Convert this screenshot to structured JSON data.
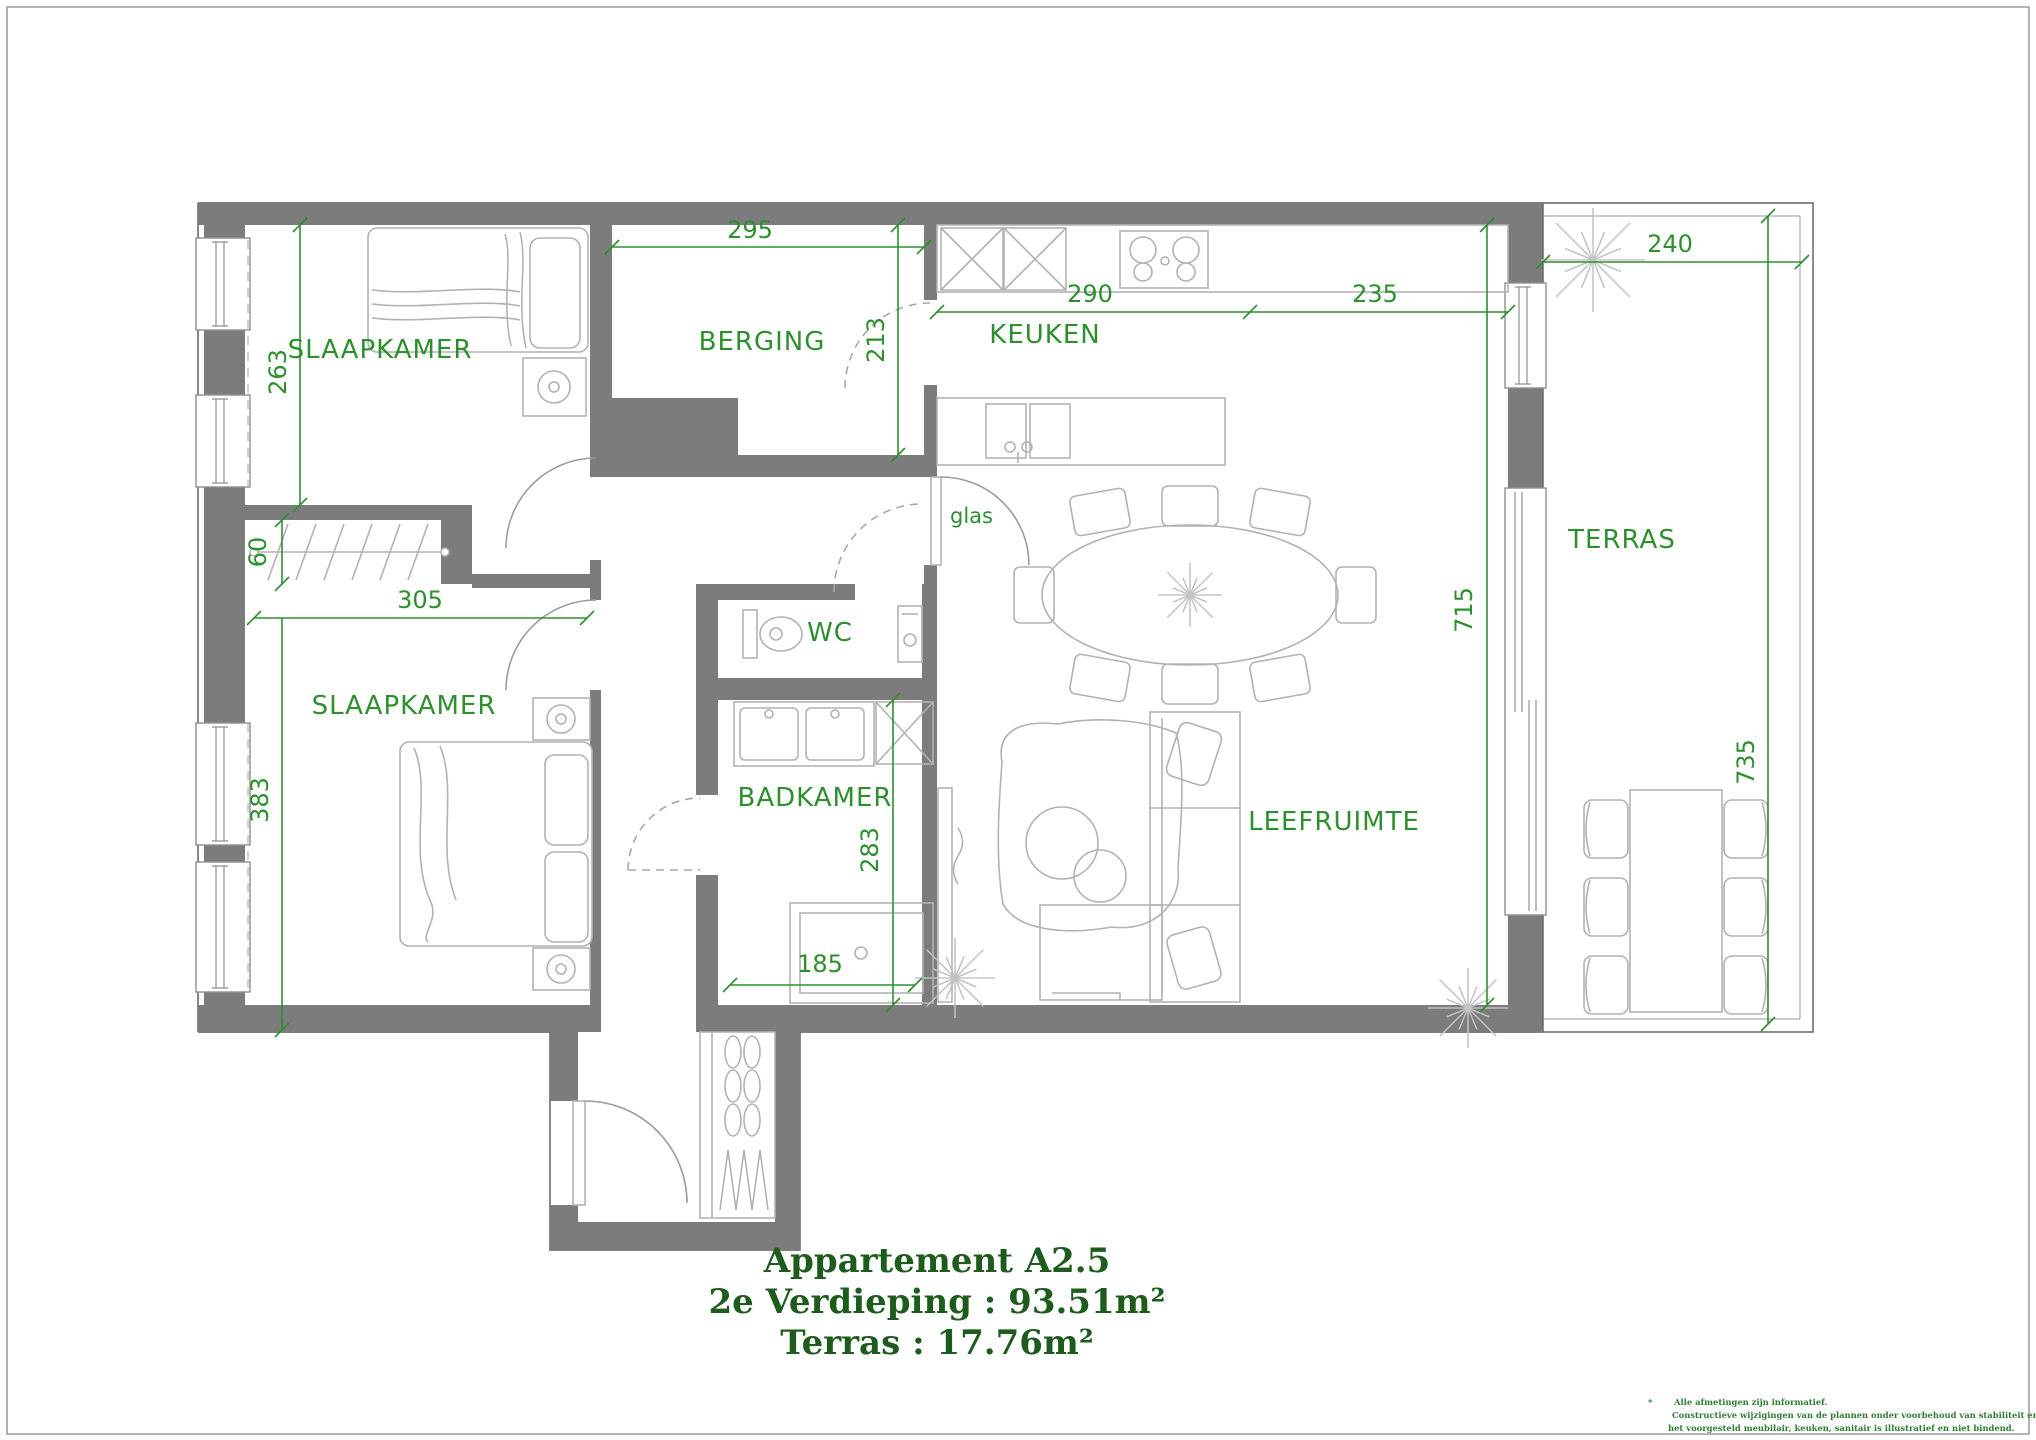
{
  "document": {
    "type": "apartment-floorplan"
  },
  "title": {
    "line1": "Appartement A2.5",
    "line2": "2e Verdieping : 93.51m²",
    "line3": "Terras : 17.76m²"
  },
  "rooms": {
    "bedroom_top": "SLAAPKAMER",
    "storage": "BERGING",
    "kitchen": "KEUKEN",
    "bedroom_bottom": "SLAAPKAMER",
    "wc": "WC",
    "bathroom": "BADKAMER",
    "living": "LEEFRUIMTE",
    "terrace": "TERRAS"
  },
  "dimensions": {
    "bedroom_top_height": "263",
    "storage_width": "295",
    "storage_height": "213",
    "kitchen_width_left": "290",
    "kitchen_width_right": "235",
    "terrace_width": "240",
    "closet_depth": "60",
    "bedroom_bottom_width": "305",
    "bedroom_bottom_height": "383",
    "bathroom_height": "283",
    "bathroom_width": "185",
    "living_height": "715",
    "terrace_height": "735"
  },
  "annotations": {
    "glass_door": "glas"
  },
  "footnote": {
    "marker": "*",
    "line1": "Alle afmetingen zijn informatief.",
    "line2": "Constructieve wijzigingen van de plannen onder voorbehoud van stabiliteit en technieken.",
    "line3": "het voorgesteld meubilair, keuken, sanitair is illustratief en niet bindend."
  },
  "colors": {
    "wall": "#7c7c7c",
    "dimension_green": "#2e8f2e",
    "title_green": "#1d5c1d",
    "furniture_grey": "#b5b5b5"
  }
}
